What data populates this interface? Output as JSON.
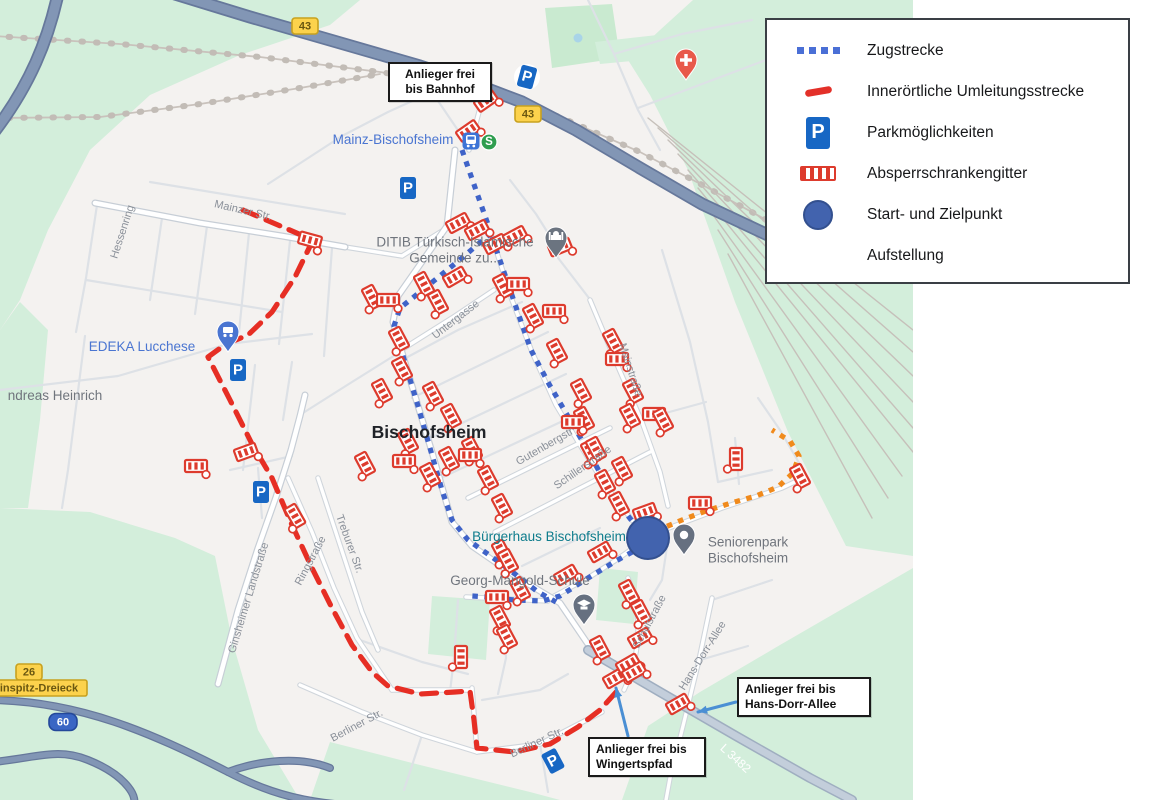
{
  "legend": {
    "items": [
      {
        "icon": "blue-dotted-line",
        "label": "Zugstrecke"
      },
      {
        "icon": "red-dash",
        "label": "Innerörtliche Umleitungsstrecke"
      },
      {
        "icon": "parking-sign",
        "label": "Parkmöglichkeiten"
      },
      {
        "icon": "barrier-gate",
        "label": "Absperrschrankengitter"
      },
      {
        "icon": "blue-circle",
        "label": "Start- und Zielpunkt"
      },
      {
        "icon": "none",
        "label": "Aufstellung"
      }
    ]
  },
  "map": {
    "colors": {
      "land": "#f4f2f0",
      "green": "#d3eedb",
      "park": "#c9ead0",
      "rail": "#c9c2bc",
      "minor_road": "#dde1e6",
      "med_casing": "#cfd5db",
      "spine_casing": "#c7ced6",
      "road_fill": "#ffffff",
      "l3482_casing": "#9faec0",
      "l3482_fill": "#c3cedb",
      "hw_casing": "#66789b",
      "hw_fill": "#8296b5",
      "zugstrecke": "#3f63c8",
      "umleitung": "#e62e24",
      "aufstellung": "#f08a1c",
      "barrier": "#dd3b2d",
      "parking": "#1767c4",
      "start_fill": "#4263ae",
      "start_stroke": "#33508f",
      "arrow": "#4a8fd4",
      "poi_blue": "#4a75d1",
      "poi_gray": "#70757d",
      "poi_teal": "#0e7c8c",
      "street_gray": "#8a9099",
      "city_dark": "#202328"
    },
    "parking_glyph": "P",
    "sbahn_glyph": "S",
    "green_areas": [
      {
        "points": "0,0 360,0 330,25 240,55 150,95 90,150 48,230 20,300 0,330"
      },
      {
        "points": "545,8 612,4 620,58 552,68",
        "fill": "#c9ead0"
      },
      {
        "points": "595,42 702,30 706,54 600,64"
      },
      {
        "points": "693,0 913,0 913,556 846,546 788,432 735,302 688,170 650,95 628,60 660,30"
      },
      {
        "points": "0,508 90,512 175,538 215,556 232,640 258,730 300,800 0,800"
      },
      {
        "points": "310,800 330,742 420,765 530,792 560,800"
      },
      {
        "points": "622,800 648,726 700,692 780,645 913,568 913,800"
      },
      {
        "points": "0,330 20,302 48,330 40,420 28,508 0,508"
      },
      {
        "points": "432,596 490,600 486,660 428,654"
      },
      {
        "points": "600,568 638,572 634,624 596,620"
      }
    ],
    "pond": {
      "x": 578,
      "y": 38,
      "r": 4.5,
      "fill": "#a9d4e8"
    },
    "roads": {
      "minor": [
        "M150,182 L345,214",
        "M97,205 L86,278 L76,332",
        "M162,218 L150,300",
        "M207,226 L195,314",
        "M249,233 L239,332",
        "M290,241 L279,344",
        "M332,248 L324,356",
        "M86,280 L282,312",
        "M0,390 L118,376 L228,344",
        "M228,344 L312,334",
        "M85,336 L68,470 L62,508",
        "M255,365 L243,470",
        "M292,362 L283,420",
        "M402,360 L458,330 L522,302",
        "M412,398 L548,332",
        "M426,440 L566,374",
        "M441,478 L582,412",
        "M522,566 L600,528",
        "M560,252 L536,214 L510,180",
        "M592,302 L552,250",
        "M470,148 L432,92 L402,62",
        "M432,92 L388,112 L342,136",
        "M342,136 L302,162 L268,184",
        "M588,0 L614,54 L638,110 L660,150",
        "M614,54 L682,34 L752,20",
        "M638,108 L702,84 L766,60",
        "M662,250 L690,342 L708,422 L718,482",
        "M640,420 L706,402",
        "M735,438 L739,484",
        "M718,482 L772,470",
        "M802,468 L780,430 L758,398",
        "M360,640 L422,662 L468,674",
        "M482,700 L540,690 L568,674",
        "M540,744 L548,792",
        "M422,735 L404,790",
        "M502,600 L506,658 L498,694",
        "M458,600 L454,658 L450,692",
        "M712,600 L772,580",
        "M700,660 L748,646",
        "M258,468 L262,518",
        "M230,470 L292,456",
        "M303,413 L352,382 L400,352",
        "M668,540 L662,580 L650,600"
      ],
      "medium": [
        "M398,352 L452,318 L494,290",
        "M468,498 L610,428",
        "M495,532 L650,452",
        "M590,300 L616,362 L642,422 L660,472 L668,506",
        "M318,478 L340,545 L362,612 L378,650",
        "M288,478 L312,532 L334,588 L357,638 L380,672 L392,690",
        "M392,690 L470,690",
        "M472,688 L477,752",
        "M300,685 L362,712 L422,735 L477,752",
        "M477,752 L540,744 L602,712",
        "M628,578 C642,612 642,652 624,690",
        "M466,597 L548,601",
        "M712,598 L699,660 L684,722 L670,778 L666,800",
        "M492,237 L512,300 L532,352 L556,405 L580,445 L605,485 L632,520 L648,538",
        "M648,538 L616,560 L588,578 L545,601",
        "M650,535 L722,508 L782,488 L803,478",
        "M345,247 L402,256 L447,228",
        "M469,150 L480,108 L488,86"
      ],
      "spine": [
        "M95,203 L200,223 L282,236 L345,247",
        "M455,150 L447,226 L398,296 L393,322 L412,386 L432,452 L452,522 L472,546 L520,579 L560,603 L596,656",
        "M218,684 L238,610 L258,548 L276,497 L291,450 L300,416 L305,395"
      ],
      "l3482": "M588,650 L660,692 L736,736 L810,778 L852,800",
      "highway": [
        "M175,-6 L250,17 L330,40 L420,66 L472,83 L522,102 L576,130 L640,168 L702,204 L770,236 L830,258",
        "M58,-6 C48,40 30,85 -6,132"
      ],
      "ramps": [
        "M-6,700 C80,702 150,732 228,772 C290,804 330,806 420,808",
        "M-6,762 C40,757 58,748 88,760 C128,776 140,800 132,806",
        "M228,772 C260,760 300,756 330,768"
      ],
      "railways": [
        "M-6,36 L120,44 L260,57 L380,72 L470,87 L560,117 L640,152 L708,188 L770,222",
        "M-6,118 L100,117 L200,104 L300,88 L380,74"
      ],
      "railyard": [
        "M648,118 L913,330",
        "M658,128 L913,352",
        "M668,140 L913,376",
        "M678,154 L913,402",
        "M688,170 L913,428",
        "M698,188 L913,452",
        "M708,208 L902,476",
        "M718,230 L888,498",
        "M728,254 L872,518"
      ]
    },
    "routes": {
      "zugstrecke": [
        "M462,150 L478,196 L491,233",
        "M491,233 L462,258 L430,284 L400,308 L394,326 L406,366 L418,406 L430,448 L442,490 L452,520 L468,540 L492,557 L515,574 L538,592 L556,602",
        "M492,237 L504,272 L517,310 L531,350 L549,384 L566,413 L583,442 L599,471 L615,499 L632,521 L643,533",
        "M643,546 L616,561 L588,578 L560,596 L543,601 L514,600 L488,597 L472,596"
      ],
      "umleitung": [
        "M243,210 L313,240 L295,277 L272,312 L248,335 L226,344 L208,357 L230,400 L252,444 L272,478 L292,525 L312,568 L332,608 L352,645 L372,672 L388,686 L420,694 L455,692 L470,691 L474,720 L477,748 L515,752 L550,744 L578,727 L600,710 L618,690"
      ],
      "aufstellung": [
        "M656,531 L682,520 L706,511 L731,503 L756,496 L778,487 L793,473 L799,456 L790,441 L772,430"
      ]
    },
    "barriers": [
      [
        486,
        101,
        -35
      ],
      [
        468,
        131,
        -35
      ],
      [
        310,
        240,
        15
      ],
      [
        458,
        223,
        -28
      ],
      [
        477,
        230,
        -28
      ],
      [
        495,
        244,
        -28
      ],
      [
        515,
        236,
        -28
      ],
      [
        560,
        247,
        -22
      ],
      [
        424,
        284,
        62
      ],
      [
        438,
        302,
        62
      ],
      [
        455,
        277,
        -30
      ],
      [
        372,
        297,
        62
      ],
      [
        388,
        300,
        0
      ],
      [
        503,
        286,
        62
      ],
      [
        518,
        284,
        0
      ],
      [
        533,
        316,
        62
      ],
      [
        554,
        311,
        0
      ],
      [
        557,
        351,
        62
      ],
      [
        613,
        341,
        62
      ],
      [
        617,
        359,
        0
      ],
      [
        633,
        391,
        62
      ],
      [
        581,
        391,
        62
      ],
      [
        584,
        419,
        62
      ],
      [
        591,
        452,
        62
      ],
      [
        630,
        416,
        62
      ],
      [
        654,
        414,
        0
      ],
      [
        663,
        420,
        62
      ],
      [
        399,
        339,
        62
      ],
      [
        402,
        369,
        62
      ],
      [
        382,
        391,
        62
      ],
      [
        433,
        394,
        62
      ],
      [
        451,
        416,
        62
      ],
      [
        472,
        449,
        62
      ],
      [
        408,
        441,
        62
      ],
      [
        365,
        464,
        62
      ],
      [
        404,
        461,
        0
      ],
      [
        430,
        475,
        62
      ],
      [
        449,
        459,
        62
      ],
      [
        470,
        455,
        0
      ],
      [
        488,
        478,
        62
      ],
      [
        502,
        506,
        62
      ],
      [
        196,
        466,
        0
      ],
      [
        246,
        452,
        -20
      ],
      [
        573,
        422,
        0
      ],
      [
        596,
        449,
        62
      ],
      [
        622,
        469,
        62
      ],
      [
        605,
        482,
        62
      ],
      [
        619,
        504,
        62
      ],
      [
        645,
        512,
        -20
      ],
      [
        700,
        503,
        0
      ],
      [
        736,
        459,
        90
      ],
      [
        800,
        476,
        62
      ],
      [
        295,
        516,
        60
      ],
      [
        502,
        552,
        62
      ],
      [
        508,
        561,
        62
      ],
      [
        520,
        589,
        62
      ],
      [
        497,
        597,
        0
      ],
      [
        566,
        575,
        -30
      ],
      [
        600,
        552,
        -30
      ],
      [
        500,
        618,
        62
      ],
      [
        507,
        637,
        62
      ],
      [
        461,
        657,
        90
      ],
      [
        629,
        592,
        62
      ],
      [
        641,
        612,
        62
      ],
      [
        640,
        638,
        -30
      ],
      [
        600,
        648,
        62
      ],
      [
        615,
        678,
        -30
      ],
      [
        628,
        664,
        -30
      ],
      [
        634,
        672,
        -30
      ],
      [
        678,
        704,
        -30
      ]
    ],
    "parking": [
      {
        "x": 527,
        "y": 77,
        "rot": 15,
        "circle": true
      },
      {
        "x": 408,
        "y": 188,
        "rot": 0,
        "circle": false
      },
      {
        "x": 238,
        "y": 370,
        "rot": 0,
        "circle": false
      },
      {
        "x": 261,
        "y": 492,
        "rot": 0,
        "circle": false
      },
      {
        "x": 553,
        "y": 761,
        "rot": -28,
        "circle": false
      }
    ],
    "pins": [
      {
        "type": "cart",
        "x": 228,
        "y": 352,
        "color": "#4a75d1"
      },
      {
        "type": "mosque",
        "x": 556,
        "y": 258,
        "color": "#6b7480"
      },
      {
        "type": "medical",
        "x": 686,
        "y": 80,
        "color": "#e8594a"
      },
      {
        "type": "dot",
        "x": 684,
        "y": 555,
        "color": "#667080"
      },
      {
        "type": "school",
        "x": 584,
        "y": 625,
        "color": "#667080"
      },
      {
        "type": "dot",
        "x": 648,
        "y": 558,
        "color": "#11808e"
      }
    ],
    "station": {
      "train_x": 471,
      "train_y": 141,
      "s_x": 489,
      "s_y": 142
    },
    "start_point": {
      "x": 648,
      "y": 538,
      "r": 21
    },
    "shields": [
      {
        "kind": "yellow",
        "text": "43",
        "x": 305,
        "y": 26
      },
      {
        "kind": "yellow",
        "text": "43",
        "x": 528,
        "y": 114
      },
      {
        "kind": "yellow",
        "text": "26",
        "x": 29,
        "y": 672
      },
      {
        "kind": "yellowwide",
        "text": "inspitz-Dreieck",
        "x": 39,
        "y": 688
      },
      {
        "kind": "blue",
        "text": "60",
        "x": 63,
        "y": 722
      }
    ],
    "arrows": [
      {
        "x1": 628,
        "y1": 736,
        "x2": 616,
        "y2": 688
      },
      {
        "x1": 736,
        "y1": 702,
        "x2": 698,
        "y2": 712
      }
    ],
    "callouts": [
      {
        "text": "Anlieger frei\nbis Bahnhof",
        "x": 388,
        "y": 62,
        "w": 88,
        "align": "center"
      },
      {
        "text": "Anlieger frei bis\nHans-Dorr-Allee",
        "x": 737,
        "y": 677,
        "w": 118,
        "align": "left"
      },
      {
        "text": "Anlieger frei bis\nWingertspfad",
        "x": 588,
        "y": 737,
        "w": 102,
        "align": "left"
      }
    ],
    "place_labels": [
      {
        "text": "Mainz-Bischofsheim",
        "x": 393,
        "y": 140,
        "color": "#4a75d1",
        "size": 13.5,
        "weight": 400,
        "rot": 0
      },
      {
        "text": "DITIB Türkisch-Islamische\nGemeinde zu...",
        "x": 455,
        "y": 250,
        "color": "#70757d",
        "size": 13.5,
        "weight": 400,
        "rot": 0
      },
      {
        "text": "EDEKA Lucchese",
        "x": 142,
        "y": 347,
        "color": "#4a75d1",
        "size": 13.5,
        "weight": 400,
        "rot": 0
      },
      {
        "text": "ndreas Heinrich",
        "x": 55,
        "y": 396,
        "color": "#70757d",
        "size": 13.5,
        "weight": 400,
        "rot": 0
      },
      {
        "text": "Bischofsheim",
        "x": 429,
        "y": 432,
        "color": "#202328",
        "size": 17.5,
        "weight": 700,
        "rot": 0
      },
      {
        "text": "Bürgerhaus Bischofsheim",
        "x": 549,
        "y": 537,
        "color": "#0e7c8c",
        "size": 13.5,
        "weight": 400,
        "rot": 0
      },
      {
        "text": "Seniorenpark\nBischofsheim",
        "x": 748,
        "y": 550,
        "color": "#70757d",
        "size": 13.5,
        "weight": 400,
        "rot": 0
      },
      {
        "text": "Georg-Mangold-Schule",
        "x": 520,
        "y": 581,
        "color": "#70757d",
        "size": 13.5,
        "weight": 400,
        "rot": 0
      }
    ],
    "street_labels": [
      {
        "text": "Hessenring",
        "x": 123,
        "y": 232,
        "rot": -72,
        "color": "#8a9099",
        "size": 11
      },
      {
        "text": "Mainzer Str.",
        "x": 243,
        "y": 211,
        "rot": 13,
        "color": "#8a9099",
        "size": 11
      },
      {
        "text": "Untergasse",
        "x": 456,
        "y": 320,
        "rot": -38,
        "color": "#8a9099",
        "size": 11
      },
      {
        "text": "Mainstraße",
        "x": 630,
        "y": 370,
        "rot": 72,
        "color": "#8a9099",
        "size": 11
      },
      {
        "text": "Gutenbergstr",
        "x": 545,
        "y": 447,
        "rot": -30,
        "color": "#8a9099",
        "size": 11
      },
      {
        "text": "Schillerstraße",
        "x": 583,
        "y": 468,
        "rot": -35,
        "color": "#8a9099",
        "size": 11
      },
      {
        "text": "Ginsheimer Landstraße",
        "x": 249,
        "y": 598,
        "rot": -73,
        "color": "#8a9099",
        "size": 11
      },
      {
        "text": "Ringstraße",
        "x": 311,
        "y": 561,
        "rot": -62,
        "color": "#8a9099",
        "size": 11
      },
      {
        "text": "Treburer Str.",
        "x": 349,
        "y": 544,
        "rot": 70,
        "color": "#8a9099",
        "size": 11
      },
      {
        "text": "Schulstraße",
        "x": 650,
        "y": 622,
        "rot": -62,
        "color": "#8a9099",
        "size": 11
      },
      {
        "text": "Hans-Dorr-Allee",
        "x": 703,
        "y": 656,
        "rot": -58,
        "color": "#8a9099",
        "size": 11
      },
      {
        "text": "Berliner Str.",
        "x": 357,
        "y": 726,
        "rot": -28,
        "color": "#8a9099",
        "size": 11
      },
      {
        "text": "Berliner Str.",
        "x": 537,
        "y": 743,
        "rot": -25,
        "color": "#8a9099",
        "size": 11
      },
      {
        "text": "L 3482",
        "x": 735,
        "y": 759,
        "rot": 42,
        "color": "#ffffff",
        "size": 12
      }
    ]
  }
}
